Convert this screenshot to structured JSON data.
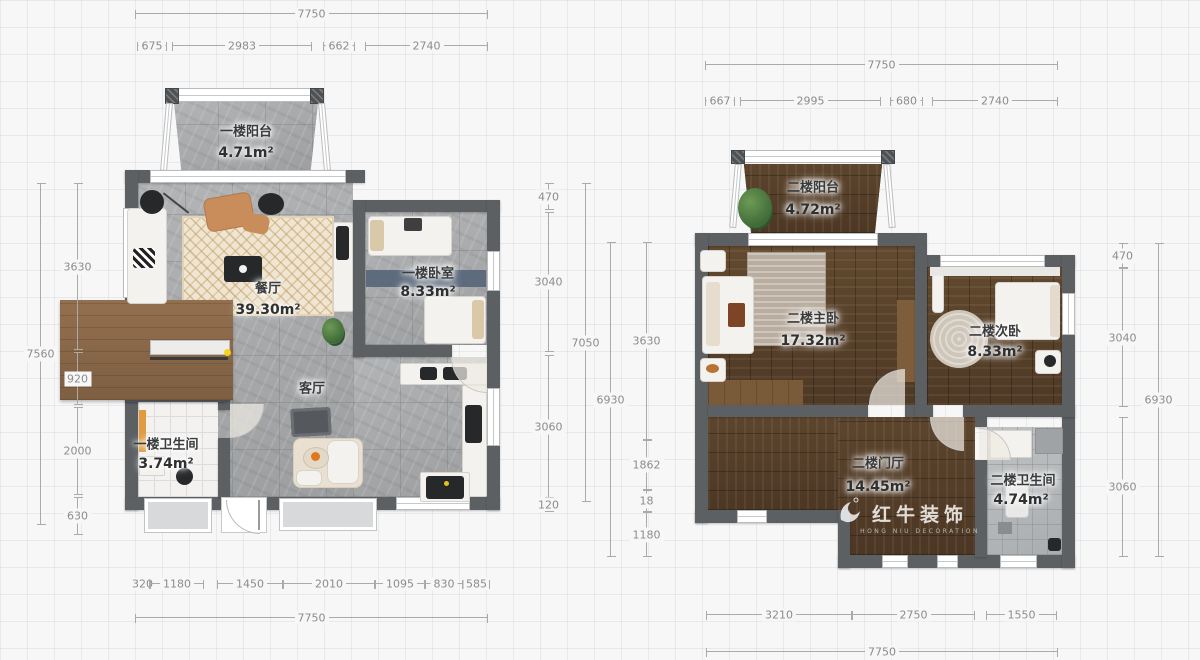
{
  "floor1": {
    "rooms": [
      {
        "name": "一楼阳台",
        "area": "4.71m²"
      },
      {
        "name": "餐厅",
        "area": "39.30m²"
      },
      {
        "name": "一楼卧室",
        "area": "8.33m²"
      },
      {
        "name": "客厅",
        "area": ""
      },
      {
        "name": "一楼卫生间",
        "area": "3.74m²"
      }
    ],
    "dims": {
      "top_total": "7750",
      "top": [
        "675",
        "2983",
        "662",
        "2740"
      ],
      "left_total": "7560",
      "left": [
        "3630",
        "920",
        "2000",
        "630"
      ],
      "right": [
        "470",
        "3040",
        "3060",
        "120"
      ],
      "right_total": "7050",
      "bottom": [
        "320",
        "1180",
        "1450",
        "2010",
        "1095",
        "830",
        "585"
      ],
      "bottom_total": "7750"
    }
  },
  "floor2": {
    "rooms": [
      {
        "name": "二楼阳台",
        "area": "4.72m²"
      },
      {
        "name": "二楼主卧",
        "area": "17.32m²"
      },
      {
        "name": "二楼次卧",
        "area": "8.33m²"
      },
      {
        "name": "二楼门厅",
        "area": "14.45m²"
      },
      {
        "name": "二楼卫生间",
        "area": "4.74m²"
      }
    ],
    "dims": {
      "top_total": "7750",
      "top": [
        "667",
        "2995",
        "680",
        "2740"
      ],
      "left_total": "6930",
      "left": [
        "3630",
        "1862",
        "18",
        "1180"
      ],
      "right": [
        "470",
        "3040",
        "3060"
      ],
      "right_total": "6930",
      "bottom": [
        "3210",
        "2750",
        "1550"
      ],
      "bottom_total": "7750"
    }
  },
  "watermark": {
    "brand": "红牛装饰",
    "tagline": "HONG NIU DECORATION"
  },
  "colors": {
    "wall": "#5c6063",
    "stone_floor": "#a8aaac",
    "wood_floor": "#5a432e",
    "dim_text": "#8b8c8d",
    "accent_yellow": "#f2d41c"
  }
}
